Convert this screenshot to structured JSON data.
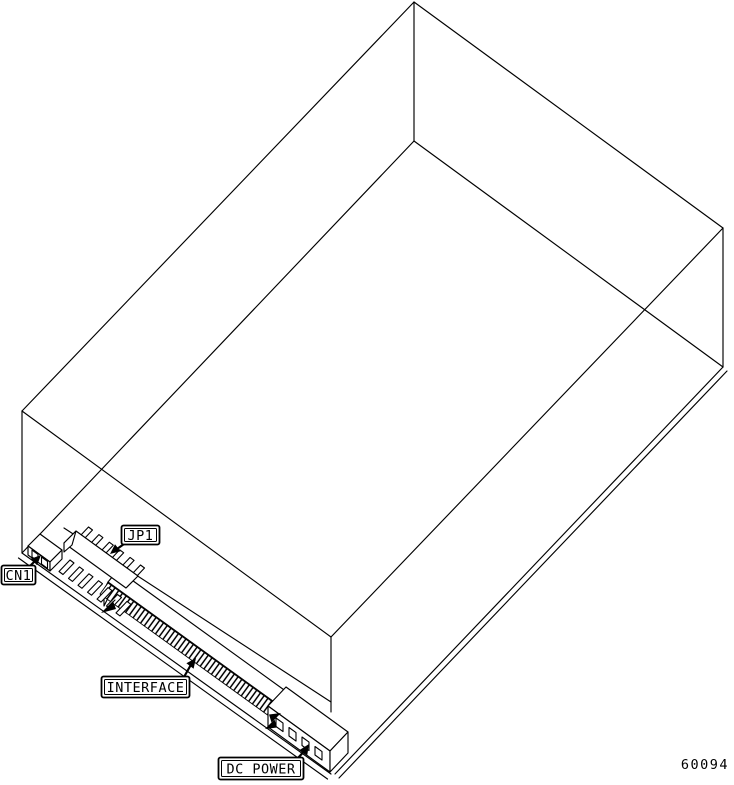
{
  "figure": {
    "description": "Isometric wireframe line drawing of a hard disk drive viewed from the underside, rear connector edge toward lower-left",
    "callouts": {
      "cn1": "CN1",
      "jp1": "JP1",
      "interface": "INTERFACE",
      "dc_power": "DC POWER"
    },
    "figure_number": "60094",
    "colors": {
      "line": "#000000",
      "background": "#ffffff"
    }
  }
}
